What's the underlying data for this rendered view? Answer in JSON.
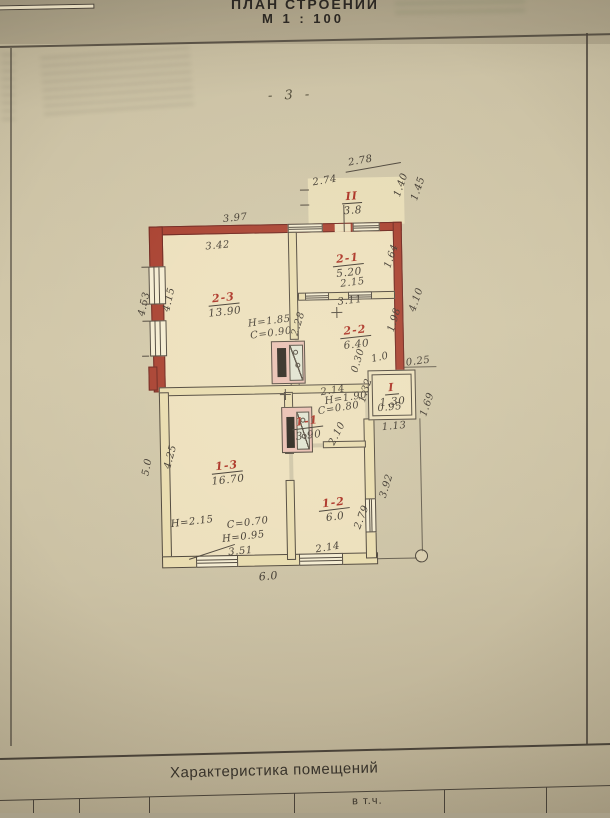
{
  "header": {
    "title": "ПЛАН СТРОЕНИЙ",
    "scale": "М 1 : 100",
    "page_number": "- 3 -"
  },
  "plan": {
    "rooms": [
      {
        "id": "II",
        "area": "3.8"
      },
      {
        "id": "2-1",
        "area": "5.20"
      },
      {
        "id": "2-3",
        "area": "13.90"
      },
      {
        "id": "2-2",
        "area": "6.40"
      },
      {
        "id": "I",
        "area": "1.30"
      },
      {
        "id": "1-1",
        "area": "3.90"
      },
      {
        "id": "1-3",
        "area": "16.70"
      },
      {
        "id": "1-2",
        "area": "6.0"
      }
    ],
    "dims": [
      "2.78",
      "2.74",
      "1.40",
      "1.45",
      "3.97",
      "3.42",
      "2.15",
      "3.11",
      "1.64",
      "4.53",
      "4.15",
      "Н=1.85",
      "С=0.90",
      "2.28",
      "1.98",
      "0.30",
      "1.0",
      "0.25",
      "4.10",
      "1.32",
      "1.69",
      "1.13",
      "0.95",
      "2.14",
      "Н=1.90",
      "С=0.80",
      "2.10",
      "5.0",
      "4.25",
      "Н=2.15",
      "С=0.70",
      "Н=0.95",
      "3.51",
      "6.0",
      "2.79",
      "3.92",
      "2.14"
    ]
  },
  "footer": {
    "section_title": "Характеристика помещений",
    "col_header": "в т.ч."
  },
  "colors": {
    "brick_wall": "#a63b2b",
    "room_label_red": "#a8291d",
    "ink": "#3b342c",
    "paper": "#c9bfa2"
  }
}
